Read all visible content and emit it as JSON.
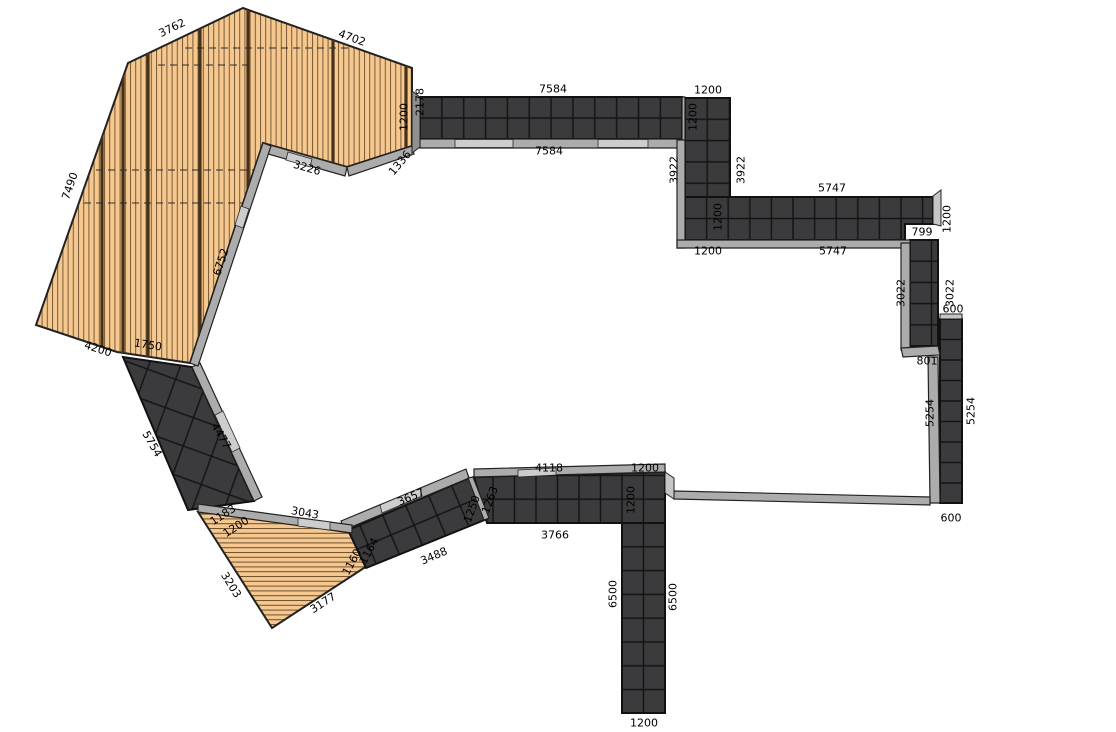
{
  "canvas": {
    "width": 1116,
    "height": 732,
    "background": "#ffffff"
  },
  "palette": {
    "deck_wood": "#F5C88F",
    "deck_plank_line": "#7A5A34",
    "deck_joist": "#46311B",
    "tile_fill": "#3B3B3D",
    "tile_grid_line": "#141414",
    "band_outline": "#111111",
    "edging": "#ACACAC",
    "edging_light": "#CDCDCD",
    "dimension_text": "#000000"
  },
  "labels": [
    {
      "text": "3762",
      "x": 172,
      "y": 28,
      "rot": -26
    },
    {
      "text": "4702",
      "x": 352,
      "y": 38,
      "rot": 20
    },
    {
      "text": "7490",
      "x": 70,
      "y": 186,
      "rot": -71
    },
    {
      "text": "4200",
      "x": 98,
      "y": 349,
      "rot": 18
    },
    {
      "text": "1750",
      "x": 148,
      "y": 345,
      "rot": 9
    },
    {
      "text": "6752",
      "x": 221,
      "y": 262,
      "rot": -72
    },
    {
      "text": "3226",
      "x": 307,
      "y": 168,
      "rot": 16
    },
    {
      "text": "1336",
      "x": 400,
      "y": 163,
      "rot": -50
    },
    {
      "text": "1200",
      "x": 404,
      "y": 117,
      "rot": -90
    },
    {
      "text": "2178",
      "x": 420,
      "y": 102,
      "rot": -90
    },
    {
      "text": "7584",
      "x": 553,
      "y": 89,
      "rot": 0
    },
    {
      "text": "7584",
      "x": 549,
      "y": 151,
      "rot": 0
    },
    {
      "text": "1200",
      "x": 708,
      "y": 90,
      "rot": 0
    },
    {
      "text": "1200",
      "x": 693,
      "y": 117,
      "rot": -90
    },
    {
      "text": "3922",
      "x": 674,
      "y": 170,
      "rot": -90
    },
    {
      "text": "3922",
      "x": 741,
      "y": 170,
      "rot": -90
    },
    {
      "text": "5747",
      "x": 832,
      "y": 188,
      "rot": 0
    },
    {
      "text": "1200",
      "x": 718,
      "y": 217,
      "rot": -90
    },
    {
      "text": "1200",
      "x": 708,
      "y": 251,
      "rot": 0
    },
    {
      "text": "5747",
      "x": 833,
      "y": 251,
      "rot": 0
    },
    {
      "text": "799",
      "x": 922,
      "y": 232,
      "rot": 0
    },
    {
      "text": "1200",
      "x": 947,
      "y": 219,
      "rot": -90
    },
    {
      "text": "3022",
      "x": 901,
      "y": 293,
      "rot": -90
    },
    {
      "text": "3022",
      "x": 950,
      "y": 293,
      "rot": -90
    },
    {
      "text": "600",
      "x": 953,
      "y": 309,
      "rot": 0
    },
    {
      "text": "801",
      "x": 927,
      "y": 361,
      "rot": 0
    },
    {
      "text": "5254",
      "x": 930,
      "y": 413,
      "rot": -90
    },
    {
      "text": "5254",
      "x": 971,
      "y": 411,
      "rot": -90
    },
    {
      "text": "600",
      "x": 951,
      "y": 518,
      "rot": 0
    },
    {
      "text": "4118",
      "x": 549,
      "y": 468,
      "rot": 0
    },
    {
      "text": "1200",
      "x": 645,
      "y": 468,
      "rot": 0
    },
    {
      "text": "1200",
      "x": 631,
      "y": 500,
      "rot": -90
    },
    {
      "text": "3766",
      "x": 555,
      "y": 535,
      "rot": 0
    },
    {
      "text": "1263",
      "x": 490,
      "y": 500,
      "rot": -70
    },
    {
      "text": "1250",
      "x": 472,
      "y": 509,
      "rot": -70
    },
    {
      "text": "3657",
      "x": 411,
      "y": 497,
      "rot": -23
    },
    {
      "text": "3488",
      "x": 434,
      "y": 556,
      "rot": -23
    },
    {
      "text": "1164",
      "x": 369,
      "y": 551,
      "rot": -62
    },
    {
      "text": "1160",
      "x": 352,
      "y": 562,
      "rot": -62
    },
    {
      "text": "6500",
      "x": 613,
      "y": 594,
      "rot": -90
    },
    {
      "text": "6500",
      "x": 673,
      "y": 597,
      "rot": -90
    },
    {
      "text": "1200",
      "x": 644,
      "y": 723,
      "rot": 0
    },
    {
      "text": "5754",
      "x": 152,
      "y": 444,
      "rot": 60
    },
    {
      "text": "4477",
      "x": 221,
      "y": 436,
      "rot": 60
    },
    {
      "text": "1183",
      "x": 223,
      "y": 515,
      "rot": -33
    },
    {
      "text": "1200",
      "x": 236,
      "y": 527,
      "rot": -33
    },
    {
      "text": "3043",
      "x": 305,
      "y": 513,
      "rot": 10
    },
    {
      "text": "3203",
      "x": 231,
      "y": 585,
      "rot": 58
    },
    {
      "text": "3177",
      "x": 323,
      "y": 603,
      "rot": -33
    }
  ]
}
